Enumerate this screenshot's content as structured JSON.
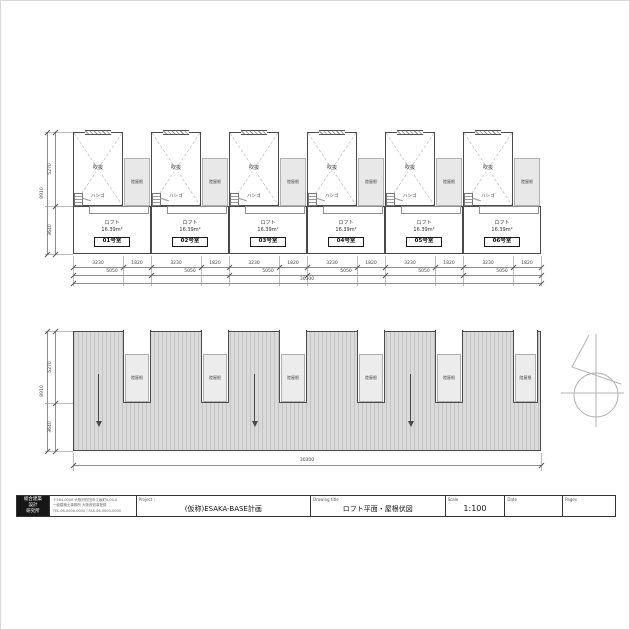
{
  "top_plan": {
    "units": [
      "01号室",
      "02号室",
      "03号室",
      "04号室",
      "05号室",
      "06号室"
    ],
    "labels": {
      "void": "吹抜",
      "ladder": "ハシゴ",
      "flat_roof": "陸屋根",
      "loft_line1": "ロフト",
      "loft_line2": "16.39m²"
    },
    "dims": {
      "tier1_pair": [
        "3230",
        "1820"
      ],
      "tier2": "5050",
      "total": "30300",
      "left_segments": [
        "5270",
        "3640"
      ],
      "left_total": "8910"
    }
  },
  "roof_plan": {
    "flat_roof_label": "陸屋根",
    "dims": {
      "left_segments": [
        "5270",
        "3640"
      ],
      "left_total": "8910",
      "bottom_total": "30300"
    }
  },
  "title_block": {
    "logo_lines": [
      "総合建築",
      "設計",
      "研究所"
    ],
    "office_lines": [
      "〒564-0000 大阪府吹田市江坂町0-00-0",
      "一級建築士事務所 大阪府知事登録",
      "TEL.06-0000-0000 / FAX.06-0000-0000"
    ],
    "project_label": "Project :",
    "project_value": "(仮称)ESAKA-BASE計画",
    "drawing_title_label": "Drawing title",
    "drawing_title_value": "ロフト平面・屋根伏図",
    "scale_label": "Scale",
    "scale_value": "1:100",
    "date_label": "Date",
    "date_value": "",
    "pages_label": "Pages",
    "pages_value": ""
  },
  "colors": {
    "wall_line": "#4a4a4a",
    "dim_line": "#8f8f8f",
    "roof_fill": "#dadada",
    "flat_roof_fill": "#e8e8e8"
  }
}
